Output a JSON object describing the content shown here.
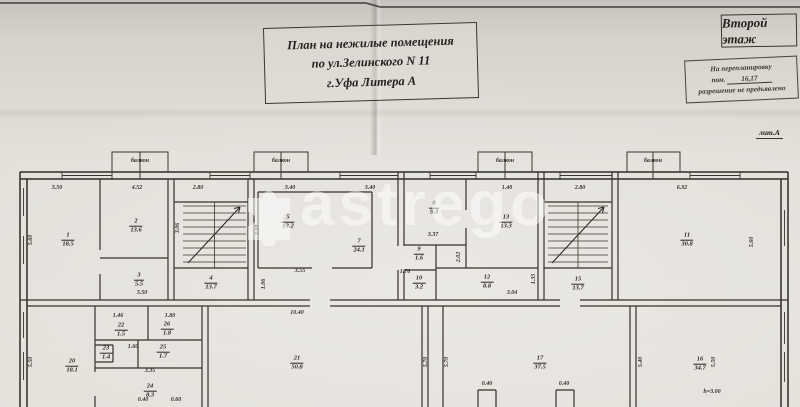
{
  "document": {
    "title_lines": [
      "План на нежилые помещения",
      "по ул.Зелинского N 11",
      "г.Уфа Литера А"
    ],
    "floor_label": "Второй этаж",
    "stamp": {
      "line1": "На перепланировку",
      "line2_prefix": "пом.",
      "line2_value": "16,17",
      "line3": "разрешение не предъявлено"
    },
    "litera_label": "лит.А",
    "watermark_text": "astrego"
  },
  "plan": {
    "balconies": [
      {
        "label": "балкон",
        "x": 140,
        "y": 161
      },
      {
        "label": "балкон",
        "x": 281,
        "y": 161
      },
      {
        "label": "балкон",
        "x": 505,
        "y": 161
      },
      {
        "label": "балкон",
        "x": 653,
        "y": 161
      }
    ],
    "rooms": [
      {
        "num": "1",
        "area": "18.5",
        "x": 68,
        "y": 240
      },
      {
        "num": "2",
        "area": "13.6",
        "x": 136,
        "y": 226
      },
      {
        "num": "3",
        "area": "5.5",
        "x": 139,
        "y": 280
      },
      {
        "num": "4",
        "area": "13.7",
        "x": 211,
        "y": 283
      },
      {
        "num": "5",
        "area": "13.2",
        "x": 288,
        "y": 222
      },
      {
        "num": "7",
        "area": "24.1",
        "x": 359,
        "y": 246
      },
      {
        "num": "8",
        "area": "9.3",
        "x": 434,
        "y": 208
      },
      {
        "num": "9",
        "area": "1.6",
        "x": 419,
        "y": 254
      },
      {
        "num": "10",
        "area": "3.2",
        "x": 419,
        "y": 283
      },
      {
        "num": "12",
        "area": "8.8",
        "x": 487,
        "y": 282
      },
      {
        "num": "13",
        "area": "13.3",
        "x": 506,
        "y": 222
      },
      {
        "num": "15",
        "area": "13.7",
        "x": 578,
        "y": 284
      },
      {
        "num": "11",
        "area": "30.8",
        "x": 687,
        "y": 240
      },
      {
        "num": "20",
        "area": "18.1",
        "x": 72,
        "y": 366
      },
      {
        "num": "22",
        "area": "1.5",
        "x": 121,
        "y": 330
      },
      {
        "num": "26",
        "area": "1.8",
        "x": 167,
        "y": 329
      },
      {
        "num": "23",
        "area": "1.4",
        "x": 106,
        "y": 353
      },
      {
        "num": "25",
        "area": "1.7",
        "x": 163,
        "y": 352
      },
      {
        "num": "24",
        "area": "8.3",
        "x": 150,
        "y": 391
      },
      {
        "num": "21",
        "area": "50.8",
        "x": 297,
        "y": 363
      },
      {
        "num": "17",
        "area": "37.5",
        "x": 540,
        "y": 363
      },
      {
        "num": "16",
        "area": "34.7",
        "x": 700,
        "y": 364
      }
    ],
    "dims": [
      {
        "v": "3.50",
        "x": 57,
        "y": 188,
        "r": 0
      },
      {
        "v": "4.52",
        "x": 137,
        "y": 188,
        "r": 0
      },
      {
        "v": "2.80",
        "x": 198,
        "y": 188,
        "r": 0
      },
      {
        "v": "3.40",
        "x": 290,
        "y": 188,
        "r": 0
      },
      {
        "v": "3.40",
        "x": 370,
        "y": 188,
        "r": 0
      },
      {
        "v": "1.40",
        "x": 507,
        "y": 188,
        "r": 0
      },
      {
        "v": "2.80",
        "x": 580,
        "y": 188,
        "r": 0
      },
      {
        "v": "6.92",
        "x": 682,
        "y": 188,
        "r": 0
      },
      {
        "v": "5.60",
        "x": 31,
        "y": 240,
        "r": -90
      },
      {
        "v": "3.06",
        "x": 178,
        "y": 228,
        "r": -90
      },
      {
        "v": "3.08",
        "x": 258,
        "y": 230,
        "r": -90
      },
      {
        "v": "3.55",
        "x": 300,
        "y": 271,
        "r": 0
      },
      {
        "v": "1.06",
        "x": 264,
        "y": 284,
        "r": -90
      },
      {
        "v": "3.50",
        "x": 142,
        "y": 293,
        "r": 0
      },
      {
        "v": "3.37",
        "x": 433,
        "y": 235,
        "r": 0
      },
      {
        "v": "1.76",
        "x": 405,
        "y": 272,
        "r": 0
      },
      {
        "v": "2.02",
        "x": 459,
        "y": 257,
        "r": -90
      },
      {
        "v": "3.04",
        "x": 512,
        "y": 293,
        "r": 0
      },
      {
        "v": "1.35",
        "x": 534,
        "y": 279,
        "r": -90
      },
      {
        "v": "5.60",
        "x": 752,
        "y": 242,
        "r": -90
      },
      {
        "v": "10.40",
        "x": 297,
        "y": 313,
        "r": 0
      },
      {
        "v": "1.46",
        "x": 118,
        "y": 316,
        "r": 0
      },
      {
        "v": "1.80",
        "x": 170,
        "y": 316,
        "r": 0
      },
      {
        "v": "1.60",
        "x": 133,
        "y": 347,
        "r": 0
      },
      {
        "v": "3.35",
        "x": 150,
        "y": 371,
        "r": 0
      },
      {
        "v": "0.40",
        "x": 143,
        "y": 400,
        "r": 0
      },
      {
        "v": "0.60",
        "x": 176,
        "y": 400,
        "r": 0
      },
      {
        "v": "5.50",
        "x": 31,
        "y": 362,
        "r": -90
      },
      {
        "v": "5.70",
        "x": 426,
        "y": 362,
        "r": -90
      },
      {
        "v": "5.70",
        "x": 447,
        "y": 362,
        "r": -90
      },
      {
        "v": "5.40",
        "x": 641,
        "y": 362,
        "r": -90
      },
      {
        "v": "5.50",
        "x": 714,
        "y": 362,
        "r": -90
      },
      {
        "v": "0.40",
        "x": 487,
        "y": 384,
        "r": 0
      },
      {
        "v": "0.40",
        "x": 564,
        "y": 384,
        "r": 0
      },
      {
        "v": "h=3.00",
        "x": 712,
        "y": 392,
        "r": 0
      }
    ]
  }
}
